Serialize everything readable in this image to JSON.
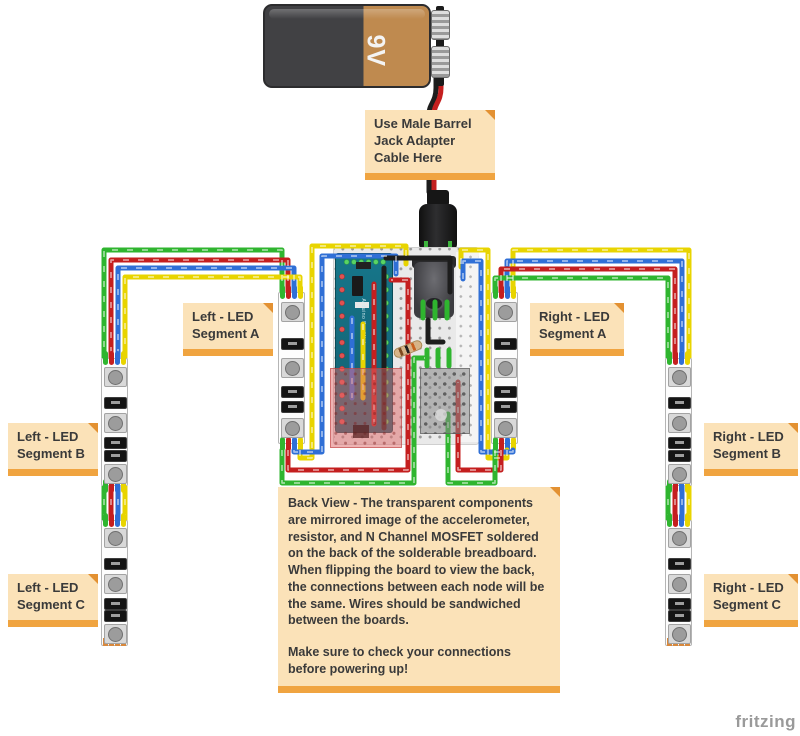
{
  "diagram": {
    "watermark": "fritzing",
    "battery": {
      "label": "9V"
    },
    "board_label": "Arduino Pro Mini",
    "notes": {
      "barrel": "Use Male Barrel Jack Adapter Cable Here",
      "left_a": "Left - LED Segment A",
      "right_a": "Right - LED Segment A",
      "left_b": "Left - LED Segment B",
      "right_b": "Right - LED Segment B",
      "left_c": "Left - LED Segment C",
      "right_c": "Right - LED Segment C",
      "back_view_p1": "Back View - The transparent components are mirrored image of the accelerometer, resistor, and N Channel MOSFET soldered on the back of the solderable breadboard. When flipping the board to view the back, the connections between each node will be the same. Wires should be sandwiched between the boards.",
      "back_view_p2": "Make sure to check your connections before powering up!"
    },
    "components": [
      "9V battery",
      "male barrel jack adapter cable",
      "barrel jack socket",
      "Arduino Pro Mini",
      "solderable breadboard",
      "accelerometer (mirrored)",
      "resistor",
      "N Channel MOSFET (mirrored)",
      "RGB LED strip segments A/B/C left",
      "RGB LED strip segments A/B/C right"
    ],
    "colors": {
      "wire_green": "#2fb52f",
      "wire_red": "#c41f1f",
      "wire_blue": "#2f6fd6",
      "wire_yellow": "#e8d400",
      "wire_black": "#1d1d1d",
      "note_bg": "#fbe2b8",
      "note_bar": "#f0a440",
      "battery_dark": "#414144",
      "battery_tan": "#bf8a4f",
      "pcb_teal": "#16768a"
    }
  }
}
